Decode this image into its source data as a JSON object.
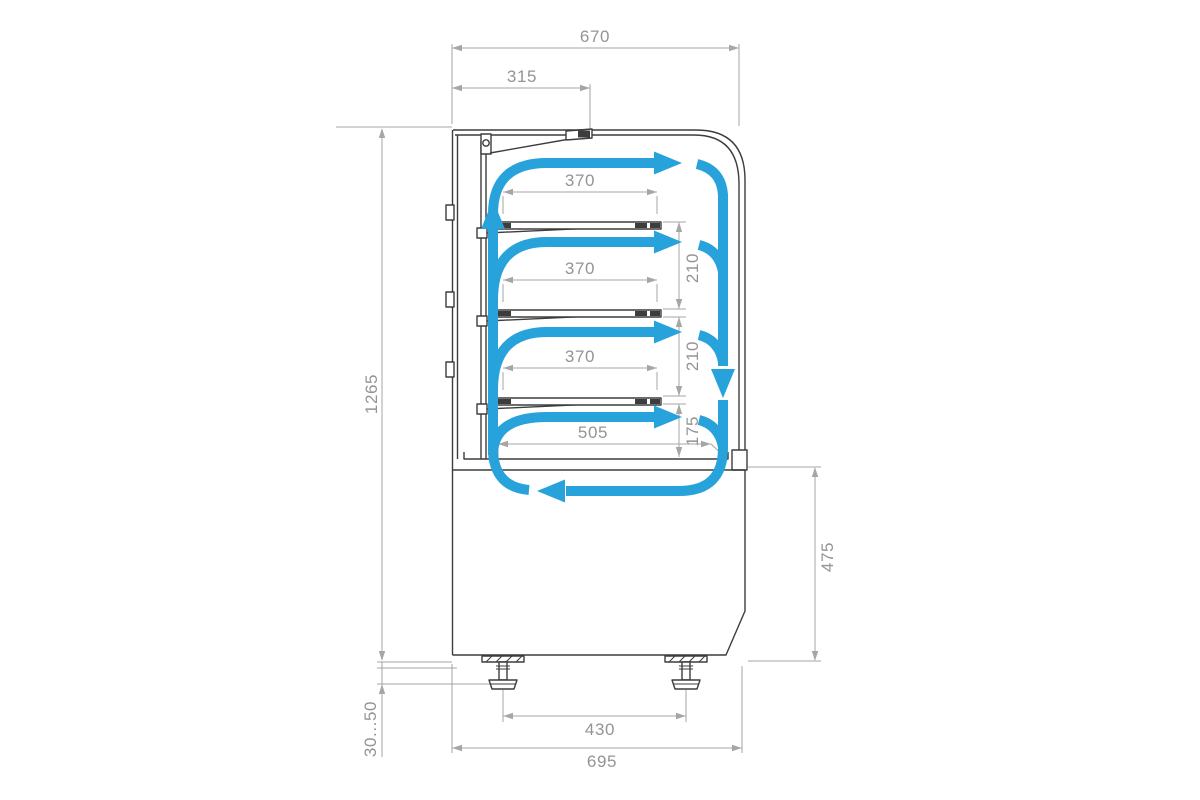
{
  "colors": {
    "airflow": "#27A2DB",
    "outline": "#3D3D3D",
    "dimension_line": "#A6A6A6",
    "dimension_text": "#949494"
  },
  "dims": {
    "top_width": "670",
    "lid_width": "315",
    "shelf1_width": "370",
    "shelf2_width": "370",
    "shelf3_width": "370",
    "gap_shelf1_shelf2": "210",
    "gap_shelf2_shelf3": "210",
    "gap_shelf3_deck": "175",
    "deck_width": "505",
    "overall_height": "1265",
    "base_height": "475",
    "foot_adjust_range": "30...50",
    "foot_spacing": "430",
    "base_width": "695"
  }
}
